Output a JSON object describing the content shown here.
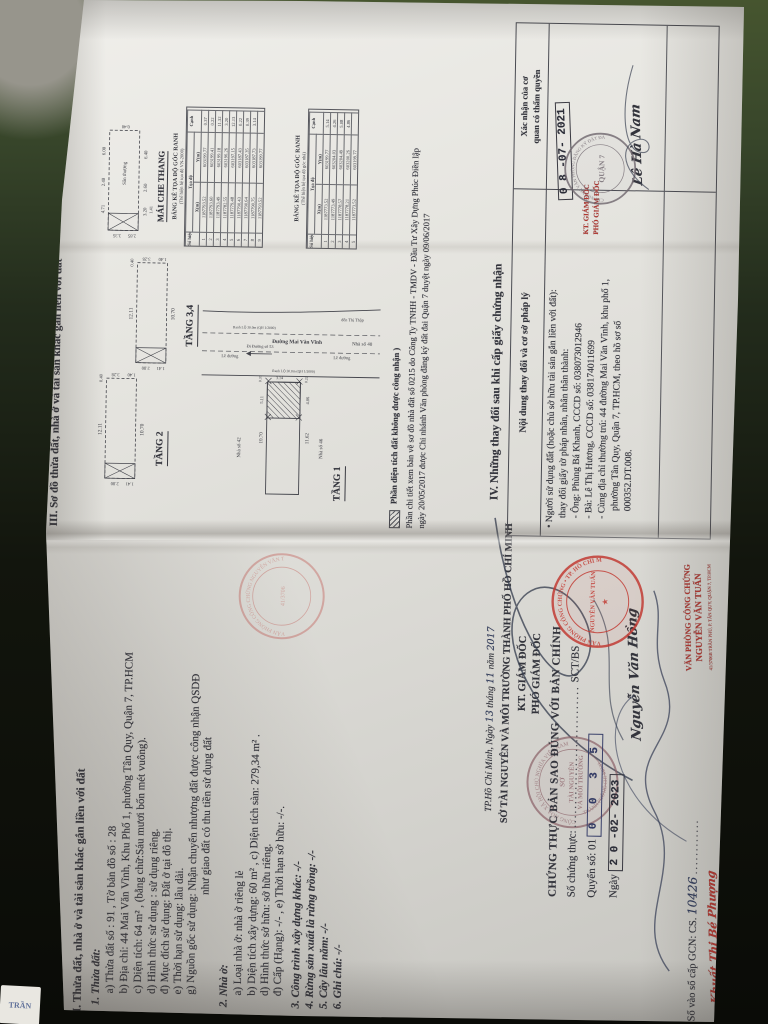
{
  "colors": {
    "ink": "#33343c",
    "stamp_red": "#b5352e",
    "bright_red": "#c22f28",
    "seal_gray": "#6f666e",
    "hand_blue": "#2e3a5c",
    "paper": "#e7e6e1"
  },
  "corner_label": "TRẦN",
  "page2": {
    "heading": "II. Thửa đất, nhà ở và tài sản khác gắn liền với đất",
    "s1_title": "1. Thửa đất:",
    "s1a": "a) Thửa đất số : 91 , Tờ bản đồ số : 28",
    "s1b": "b) Địa chỉ: 44 Mai Văn Vĩnh, Khu Phố 1, phường Tân Quy, Quận 7, TP.HCM",
    "s1c": "c) Diện tích: 64 m² , (bằng chữ:Sáu mươi bốn mét vuông).",
    "s1d": "d) Hình thức sử dụng : sử dụng riêng.",
    "s1dd": "đ) Mục đích sử dụng: Đất ở tại đô thị.",
    "s1e": "e) Thời hạn sử dụng: lâu dài.",
    "s1g1": "g) Nguồn gốc sử dụng: Nhận chuyển nhượng đất được công nhận QSDĐ",
    "s1g2": "như giao đất có thu tiền sử dụng đất",
    "s2_title": "2. Nhà ở:",
    "s2a": "a) Loại nhà ở: nhà ở riêng lẻ",
    "s2b": "b) Diện tích xây dựng: 60 m² , c) Diện tích sàn: 279,34 m² .",
    "s2d": "d) Hình thức sở hữu: sở hữu riêng.",
    "s2dd": "đ) Cấp (Hạng): -/- , e) Thời hạn sở hữu: -/-.",
    "s3": "3. Công trình xây dựng khác: -/-",
    "s4": "4. Rừng sản xuất là rừng trồng: -/-",
    "s5": "5. Cây lâu năm: -/-",
    "s6": "6. Ghi chú: -/-"
  },
  "sign_block": {
    "place1": "TP.Hồ Chí Minh, Ngày",
    "day": "13",
    "mid1": "tháng",
    "month": "11",
    "mid2": "năm",
    "year": "2017",
    "org": "SỞ TÀI NGUYÊN VÀ MÔI TRƯỜNG THÀNH PHỐ HỒ CHÍ MINH",
    "kt": "KT. GIÁM ĐỐC",
    "role": "PHÓ GIÁM ĐỐC",
    "signer": "Nguyễn Văn Hồng",
    "seal_ring_top": "CỘNG HÒA XÃ HỘI CHỦ NGHĨA VIỆT NAM",
    "seal_c1": "SỞ",
    "seal_c2": "TÀI NGUYÊN",
    "seal_c3": "VÀ MÔI TRƯỜNG",
    "seal_ring_bottom": "THÀNH PHỐ HỒ CHÍ MINH"
  },
  "notary": {
    "line1": "CHỨNG THỰC BẢN SAO ĐÚNG VỚI BẢN CHÍNH",
    "l2a": "Số chứng thực:",
    "l2dots": "..............................",
    "l2b": "SCT/BS",
    "l3a": "Quyển số: 01",
    "digits": "0 0 3 5",
    "l4a": "Ngày",
    "date": "2 0 -02- 2023",
    "gcn": "Số vào sổ cấp GCN: CS.",
    "gcn_hand": "10426",
    "gcn_dots": "............",
    "signer_red": "Khuất Thị Bé Phượng",
    "stamp_l1": "VĂN PHÒNG CÔNG CHỨNG",
    "stamp_l2": "NGUYỄN VĂN TUẤN",
    "stamp_l3": "41/3706B TRẦN PHÚ, P. TÂN QUY, QUẬN 7, TP.HCM",
    "seal_ring": "VĂN PHÒNG CÔNG CHỨNG • TP. HỒ CHÍ MINH",
    "seal_c1": "NGUYỄN VĂN TUẤN",
    "seal_star": "★",
    "lai_ring": "VĂN PHÒNG CÔNG CHỨNG NGUYỄN VĂN TUẤN",
    "lai_c": "41/3706"
  },
  "page3": {
    "heading": "III. Sơ đồ thửa đất, nhà ở và tài sản khác gắn liền với đất",
    "legend": "Phần diện tích đất không được công nhận )",
    "note1": "Phần chi tiết xem bản vẽ sơ đồ nhà đất số 0215 do Công Ty TNHH - TMDV - Đầu Tư Xây Dựng Phúc Điền lập",
    "note2": "ngày 20/05/2017 được Chi nhánh Văn phòng đăng ký đất đai Quận 7 duyệt ngày 09/06/2017",
    "iv_heading": "IV. Những thay đổi sau khi cấp giấy chứng nhận",
    "col1": "Nội dung thay đổi và cơ sở pháp lý",
    "col2a": "Xác nhận của cơ",
    "col2b": "quan có thẩm quyền",
    "e1": "• Người sử dụng đất (hoặc chủ sở hữu tài sản gắn liền với đất):",
    "e2": "thay đổi giấy tờ pháp nhân, nhân thân thành:",
    "e3": "- Ông: Phùng Bá Khanh, CCCD số: 038073012946",
    "e4": "- Bà: Lê Thị Hương, CCCD số: 038174011699",
    "e5": "- Cùng địa chỉ thường trú: 44 đường Mai Văn Vĩnh, khu phố 1,",
    "e6": "phường Tân Quy, Quận 7, TP.HCM, theo hồ sơ số",
    "e7": "000352.DT.008.",
    "date_stamp": "0 8 -07- 2021",
    "kt2": "KT. GIÁM ĐỐC",
    "role2": "PHÓ GIÁM ĐỐC",
    "signer2": "Lê Hà Nam",
    "seal2_ring": "CHI NHÁNH VĂN PHÒNG ĐĂNG KÝ ĐẤT ĐAI",
    "seal2_center": "QUẬN 7"
  },
  "tables": {
    "t1": {
      "title": "BẢNG KÊ TỌA ĐỘ GÓC RANH",
      "subtitle": "(Thể hiện hệ tọa độ VN-2000)",
      "h_point": "Số hiệu điểm",
      "h_coord": "Tọa độ",
      "h_x": "X(m)",
      "h_y": "Y(m)",
      "h_edge": "Cạnh",
      "rows": [
        [
          "1",
          "1187793.52",
          "603199.77",
          "0.37"
        ],
        [
          "2",
          "1187793.60",
          "603199.41",
          "0.22"
        ],
        [
          "3",
          "1187793.49",
          "603199.18",
          "11.32"
        ],
        [
          "4",
          "1187782.55",
          "603196.26",
          "3.20"
        ],
        [
          "5",
          "1187779.48",
          "603197.15",
          "12.13"
        ],
        [
          "6",
          "1187790.43",
          "603187.43",
          "0.22"
        ],
        [
          "7",
          "1187790.64",
          "603187.35",
          "0.39"
        ],
        [
          "8",
          "1187790.75",
          "603187.73",
          "3.14"
        ],
        [
          "9",
          "1187793.52",
          "603199.77",
          ""
        ]
      ]
    },
    "t2": {
      "title": "BẢNG KÊ TỌA ĐỘ GÓC RANH",
      "subtitle": "(Thể hiện hệ tọa độ góc nhà)",
      "h_point": "Số hiệu điểm",
      "h_coord": "Tọa độ",
      "h_x": "X(m)",
      "h_y": "Y(m)",
      "h_edge": "Cạnh",
      "rows": [
        [
          "1",
          "1187773.52",
          "603199.77",
          "5.14"
        ],
        [
          "2",
          "1187773.49",
          "603204.03",
          "4.26"
        ],
        [
          "3",
          "1187778.57",
          "603204.49",
          "5.08"
        ],
        [
          "4",
          "1187778.21",
          "603200.26",
          "4.86"
        ],
        [
          "5",
          "1187773.52",
          "603199.77",
          ""
        ]
      ]
    }
  },
  "floorplans": {
    "tang2": {
      "label": "TẦNG 2",
      "top": "12.11",
      "bottom": "10.70",
      "l1": "2.80",
      "l2": "1.41",
      "r1": "3.28",
      "r2": "1.40",
      "r3": "0.40"
    },
    "tang34": {
      "label": "TẦNG 3,4",
      "top": "12.11",
      "bottom": "10.70",
      "l1": "2.80",
      "l2": "1.41",
      "r1": "3.28",
      "r2": "1.40",
      "r3": "0.40"
    },
    "maiche": {
      "label": "MÁI CHE THANG",
      "t1": "4.71",
      "t2": "2.40",
      "t3": "6.00",
      "b1": "6.40",
      "b2": "2.60",
      "b3": "3.20",
      "lf1": "3.35",
      "lf2": "2.85",
      "rt": "0.40",
      "k1": "1.41",
      "inner": "Sân thượng"
    }
  },
  "siteplan": {
    "label": "TẦNG 1",
    "street": "Đường Mai Văn Vĩnh",
    "curb1": "Lề đường",
    "curb2": "Lề đường",
    "dir1": "Đi Đường số 53",
    "dir2": "đến Thị Thập",
    "ranh1": "Ranh LỘ 30.0m (QH 1/2000)",
    "ranh2": "Ranh LỘ 30.0m (QH 1/2000)",
    "n42": "Nhà số 42",
    "n46": "Nhà số 46",
    "n40": "Nhà số 40",
    "d_top": "10.70",
    "d_bottom": "11.62",
    "d1": "0.37",
    "d2": "0.22",
    "d3": "3.14",
    "d4": "5.11",
    "d5": "4.86"
  }
}
